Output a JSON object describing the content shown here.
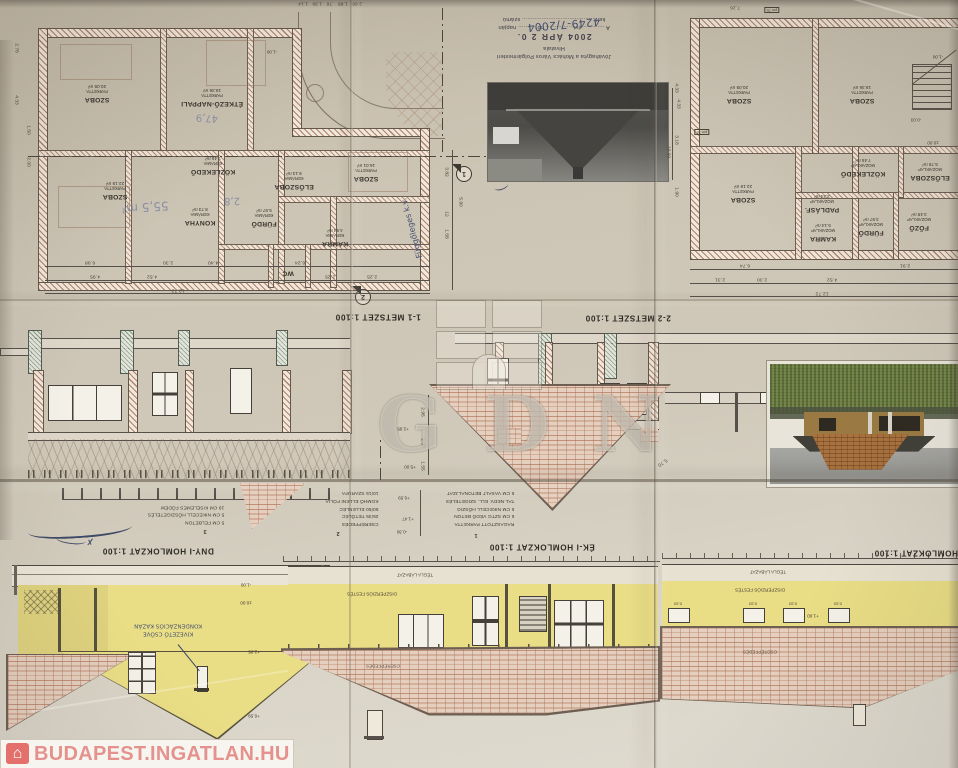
{
  "logo_bar": {
    "text": "BUDAPEST.INGATLAN.HU"
  },
  "watermark": {
    "text": "GDN"
  },
  "stamp": {
    "line1": "Jóváhagyta a Mohács Város Polgármesteri",
    "line2": "Hivatala",
    "date": "2004 ÁPR 2 0.",
    "line3": "A ............ évi ............... hó .......... napján",
    "number_hw": "4249-7/2004",
    "line4": "kelt ......................................... számú"
  },
  "plans": {
    "left": {
      "rooms": [
        {
          "name": "SZOBA",
          "floor": "PARKETTA",
          "area": "20.09 m²"
        },
        {
          "name": "ÉTKEZŐ-NAPPALI",
          "floor": "PARKETTA",
          "area": "19.36 m²"
        },
        {
          "name": "SZOBA",
          "floor": "PARKETTA",
          "area": "22.19 m²"
        },
        {
          "name": "KÖZLEKEDŐ",
          "floor": "KERÁMIA",
          "area": "7.46 m²"
        },
        {
          "name": "KONYHA",
          "floor": "KERÁMIA",
          "area": "8.73 m²"
        },
        {
          "name": "FÜRDŐ",
          "floor": "KERÁMIA",
          "area": "5.97 m²"
        },
        {
          "name": "ELŐSZOBA",
          "floor": "KERÁMIA",
          "area": "9.13 m²"
        },
        {
          "name": "SZOBA",
          "floor": "PARKETTA",
          "area": "16.01 m²"
        },
        {
          "name": "KAMRA",
          "floor": "KERÁMIA",
          "area": "4.94 m²"
        },
        {
          "name": "WC",
          "floor": "",
          "area": ""
        }
      ],
      "handwritten": {
        "pencil_area": "55,5 m²",
        "pencil_1": "47,9",
        "pencil_2": "2,8",
        "pen_note": "Függőleges k.v."
      },
      "level_terrace": "-1.00",
      "marker_1": "1",
      "marker_2": "2"
    },
    "right": {
      "rooms": [
        {
          "name": "SZOBA",
          "floor": "PARKETTA",
          "area": "20.09 m²"
        },
        {
          "name": "SZOBA",
          "floor": "PARKETTA",
          "area": "19.36 m²"
        },
        {
          "name": "SZOBA",
          "floor": "PARKETTA",
          "area": "22.19 m²"
        },
        {
          "name": "KÖZLEKEDŐ",
          "floor": "MOZAIKLAP",
          "area": "7.46 m²"
        },
        {
          "name": "PADLÁSF.",
          "floor": "MOZAIKLAP",
          "area": "3.24 m²"
        },
        {
          "name": "KAMRA",
          "floor": "MOZAIKLAP",
          "area": "5.14 m²"
        },
        {
          "name": "FÜRDŐ",
          "floor": "MOZAIKLAP",
          "area": "3.97 m²"
        },
        {
          "name": "FŐZŐ",
          "floor": "MOZAIKLAP",
          "area": "3.48 m²"
        },
        {
          "name": "ELŐSZOBA",
          "floor": "MOZAIKLAP",
          "area": "5.75 m²"
        }
      ],
      "levels": {
        "a": "-1.00",
        "b": "±0.00",
        "c": "-0.03"
      },
      "pm": "pm 70"
    }
  },
  "sections": {
    "s1": {
      "title": "1-1 METSZET 1:100"
    },
    "s2": {
      "title": "2-2 METSZET 1:100",
      "h1": "2.95",
      "h2": "2.07",
      "h3": "1.55",
      "diag": "5.70",
      "lvl1": "+5.00",
      "lvl2": "+2.95"
    }
  },
  "elevations": {
    "left": {
      "title": "DNY-I HOMLOKZAT 1:100",
      "notes": [
        "5 CM FELBETON",
        "5 CM NIKECELL HŐSZIGETELÉS",
        "19 CM KISELEMES FÖDÉM"
      ],
      "note_marker": "3",
      "hw_line_a": "KIVEZETŐ CSÖVE",
      "hw_line_b": "KONDENZÁCIÓS KAZÁN",
      "lv1": "-1.00",
      "lv2": "±0.00",
      "lv3": "+2.95",
      "lv4": "+6.59"
    },
    "center": {
      "title": "ÉK-I HOMLOKZAT 1:100",
      "notes1": [
        "RAGASZTOTT PARKETTA",
        "5 CM SZTG VÉDŐ BETON",
        "5 CM NIKECELL HŐSZIG",
        "TAL.NEDV. ELL. SZIGETELÉS",
        "5 CM VASALT BETONALJZAT"
      ],
      "notes1_marker": "1",
      "notes2": [
        "CSERÉPFEDÉS",
        "25/35 TETŐLÉC",
        "50/50 ELLENLÉC",
        "KOMHŐ ELLENI FÓLIA",
        "10/15 SZARUFA"
      ],
      "notes2_marker": "2",
      "lv1": "+6.59",
      "lv2": "+1.47",
      "lv3": "-0.30",
      "label_plinth": "TÉGLA LÁBAZAT",
      "label_paint": "DISZPERZIÓS FESTÉS",
      "label_roof": "CSERÉPFEDÉS"
    },
    "right": {
      "title": "HOMLOKZAT 1:100",
      "label_plinth": "TÉGLA LÁBAZAT",
      "label_paint": "DISZPERZIÓS FESTÉS",
      "label_roof": "CSERÉPFEDÉS",
      "window_size": "0.33",
      "level": "+1.60"
    }
  },
  "dims": {
    "top_chain": "2.68   1.88   .76   1.30   1.14",
    "lb1a": "6.98",
    "lb1b": "2.30",
    "lb1c": "4.40",
    "lb1d": "6.24",
    "lb2a": "4.95",
    "lb2b": "4.52",
    "lb2c": "2.25",
    "lb2d": "2.25",
    "lb3": "12.72",
    "ls1": "2.78",
    "ls2": "4.33",
    "ls3": "1.50",
    "ls4": "2.00",
    "mc1": "3.82",
    "mc2": "5.90",
    "mc3": "12",
    "mc4": "1.58",
    "rb1a": "6.74",
    "rb1b": "2.91",
    "rb2a": "2.31",
    "rb2b": "2.30",
    "rb2c": "4.52",
    "rb3": "12.72",
    "rs1": "4.33",
    "rs2": "3.18",
    "rs3": "1.90",
    "rt1": "7.26",
    "ph1": "4.33",
    "ph2": "10.00"
  }
}
